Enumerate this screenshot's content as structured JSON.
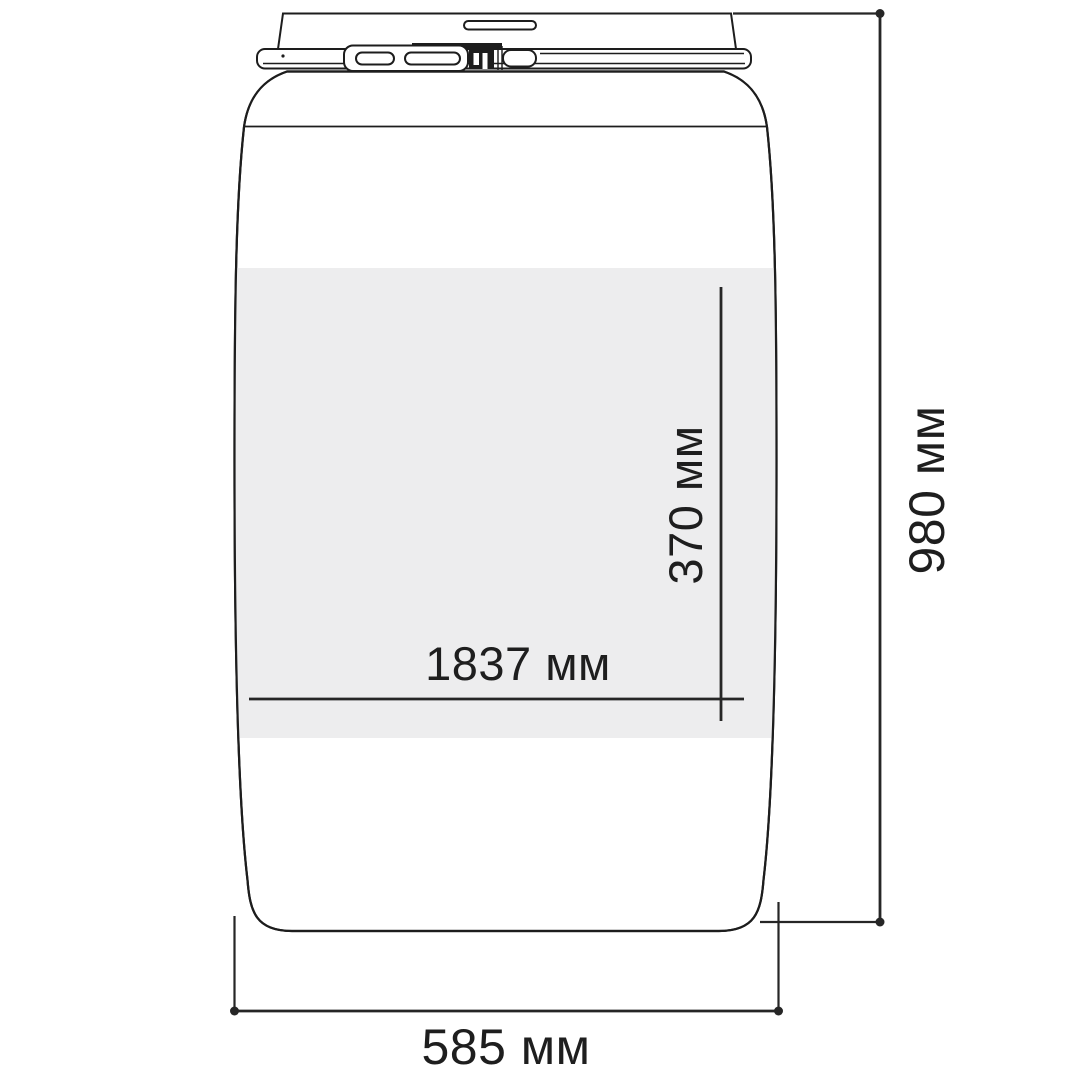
{
  "diagram": {
    "subject": "plastic drum with clamp-ring lid, dimensional drawing",
    "dimensions": {
      "height": "980 мм",
      "diameter": "585 мм",
      "label_length": "1837 мм",
      "label_height": "370 мм"
    },
    "colors": {
      "line": "#1d1d1d",
      "dimension_line": "#262626",
      "label_band": "#ededee",
      "background": "#ffffff"
    }
  }
}
